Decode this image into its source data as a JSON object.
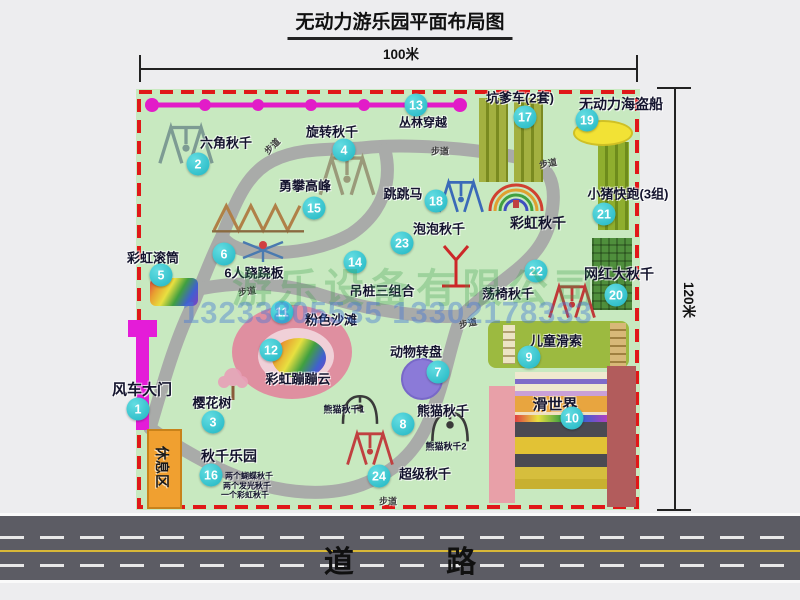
{
  "title": "无动力游乐园平面布局图",
  "dims": {
    "w": "100米",
    "h": "120米"
  },
  "road": {
    "label": "道 路"
  },
  "watermark": {
    "company": "游乐设备有限公司",
    "phone": "13233805535 13302178333"
  },
  "colors": {
    "map_bg": "#c8e9c0",
    "border_red": "#e01818",
    "path_gray": "#a8a8a8",
    "badge_cyan": "#2fc4cc",
    "magenta": "#e41cd8",
    "road_dark": "#5c5c64",
    "label_dark": "#14142e"
  },
  "attractions": [
    {
      "num": "1",
      "label": "风车大门",
      "bx": 138,
      "by": 409,
      "lx": 142,
      "ly": 389,
      "ls": 15
    },
    {
      "num": "2",
      "label": "六角秋千",
      "bx": 198,
      "by": 164,
      "lx": 226,
      "ly": 142
    },
    {
      "num": "3",
      "label": "樱花树",
      "bx": 213,
      "by": 422,
      "lx": 212,
      "ly": 402
    },
    {
      "num": "4",
      "label": "旋转秋千",
      "bx": 344,
      "by": 150,
      "lx": 332,
      "ly": 131
    },
    {
      "num": "5",
      "label": "彩虹滚筒",
      "bx": 161,
      "by": 275,
      "lx": 153,
      "ly": 257
    },
    {
      "num": "6",
      "label": "6人跷跷板",
      "bx": 224,
      "by": 254,
      "lx": 254,
      "ly": 272
    },
    {
      "num": "7",
      "label": "动物转盘",
      "bx": 438,
      "by": 372,
      "lx": 416,
      "ly": 351
    },
    {
      "num": "8",
      "label": "熊猫秋千",
      "bx": 403,
      "by": 424,
      "lx": 443,
      "ly": 410
    },
    {
      "num": "9",
      "label": "儿童滑索",
      "bx": 529,
      "by": 357,
      "lx": 556,
      "ly": 340
    },
    {
      "num": "10",
      "label": "滑世界",
      "bx": 572,
      "by": 418,
      "lx": 555,
      "ly": 404,
      "ls": 15
    },
    {
      "num": "11",
      "label": "粉色沙滩",
      "bx": 282,
      "by": 312,
      "lx": 331,
      "ly": 319
    },
    {
      "num": "12",
      "label": "彩虹蹦蹦云",
      "bx": 271,
      "by": 350,
      "lx": 298,
      "ly": 378
    },
    {
      "num": "13",
      "label": "丛林穿越",
      "bx": 416,
      "by": 105,
      "lx": 423,
      "ly": 122,
      "ls": 12
    },
    {
      "num": "14",
      "label": "吊桩三组合",
      "bx": 355,
      "by": 262,
      "lx": 382,
      "ly": 290
    },
    {
      "num": "15",
      "label": "勇攀高峰",
      "bx": 314,
      "by": 208,
      "lx": 305,
      "ly": 185
    },
    {
      "num": "16",
      "label": "秋千乐园",
      "bx": 211,
      "by": 475,
      "lx": 229,
      "ly": 456,
      "ls": 14
    },
    {
      "num": "17",
      "label": "坑爹车(2套)",
      "bx": 525,
      "by": 117,
      "lx": 520,
      "ly": 97
    },
    {
      "num": "18",
      "label": "跳跳马",
      "bx": 436,
      "by": 201,
      "lx": 403,
      "ly": 193
    },
    {
      "num": "19",
      "label": "无动力海盗船",
      "bx": 587,
      "by": 120,
      "lx": 621,
      "ly": 104,
      "ls": 14
    },
    {
      "num": "20",
      "label": "网红大秋千",
      "bx": 616,
      "by": 295,
      "lx": 619,
      "ly": 274,
      "ls": 14
    },
    {
      "num": "21",
      "label": "小猪快跑(3组)",
      "bx": 604,
      "by": 214,
      "lx": 628,
      "ly": 193
    },
    {
      "num": "22",
      "label": "荡椅秋千",
      "bx": 536,
      "by": 271,
      "lx": 508,
      "ly": 293
    },
    {
      "num": "23",
      "label": "泡泡秋千",
      "bx": 402,
      "by": 243,
      "lx": 439,
      "ly": 228
    },
    {
      "num": "24",
      "label": "超级秋千",
      "bx": 379,
      "by": 476,
      "lx": 425,
      "ly": 473
    }
  ],
  "texts": [
    {
      "t": "彩虹秋千",
      "x": 538,
      "y": 223,
      "s": 14
    },
    {
      "t": "休息区",
      "x": 162,
      "y": 467,
      "s": 14,
      "rot": 90,
      "c": "#1a1a1a"
    },
    {
      "t": "步道",
      "x": 272,
      "y": 146,
      "s": 9,
      "rot": -45,
      "c": "#3c3c3c"
    },
    {
      "t": "步道",
      "x": 440,
      "y": 151,
      "s": 9,
      "c": "#3c3c3c"
    },
    {
      "t": "步道",
      "x": 548,
      "y": 163,
      "s": 9,
      "rot": -10,
      "c": "#3c3c3c"
    },
    {
      "t": "步道",
      "x": 247,
      "y": 291,
      "s": 9,
      "rot": -8,
      "c": "#3c3c3c"
    },
    {
      "t": "步道",
      "x": 468,
      "y": 323,
      "s": 9,
      "rot": -12,
      "c": "#3c3c3c"
    },
    {
      "t": "步道",
      "x": 388,
      "y": 501,
      "s": 9,
      "c": "#3c3c3c"
    },
    {
      "t": "熊猫秋千1",
      "x": 344,
      "y": 409,
      "s": 9
    },
    {
      "t": "熊猫秋千2",
      "x": 446,
      "y": 446,
      "s": 9
    },
    {
      "t": "两个蝴蝶秋千",
      "x": 249,
      "y": 476,
      "s": 8
    },
    {
      "t": "两个发光秋千",
      "x": 247,
      "y": 486,
      "s": 8
    },
    {
      "t": "一个彩虹秋千",
      "x": 245,
      "y": 495,
      "s": 8
    }
  ],
  "shapes": [
    {
      "name": "windmill-gate-cap",
      "type": "rect",
      "x": 128,
      "y": 320,
      "w": 29,
      "h": 17,
      "color": "#e41cd8"
    },
    {
      "name": "windmill-gate-bar",
      "type": "rect",
      "x": 136,
      "y": 320,
      "w": 13,
      "h": 110,
      "color": "#e41cd8"
    },
    {
      "name": "rest-area-box",
      "type": "rect",
      "x": 147,
      "y": 429,
      "w": 31,
      "h": 76,
      "color": "#f0a030",
      "border": "#c8821a"
    },
    {
      "name": "kengdie-car-strip-1",
      "type": "stripes-v",
      "x": 479,
      "y": 98,
      "w": 29,
      "h": 84,
      "color": "#a3b040",
      "line": "#7a8a20"
    },
    {
      "name": "kengdie-car-strip-2",
      "type": "stripes-v",
      "x": 514,
      "y": 98,
      "w": 29,
      "h": 84,
      "color": "#a3b040",
      "line": "#7a8a20"
    },
    {
      "name": "pig-run-strip",
      "type": "stripes-v",
      "x": 598,
      "y": 142,
      "w": 31,
      "h": 88,
      "color": "#8fae2e",
      "line": "#6e8c1c"
    },
    {
      "name": "big-swing-patch",
      "type": "grid",
      "x": 592,
      "y": 238,
      "w": 40,
      "h": 72,
      "color": "#4f8f3c"
    },
    {
      "name": "zipline-strip",
      "type": "rect",
      "x": 488,
      "y": 321,
      "w": 141,
      "h": 47,
      "color": "#9cba40",
      "r": 8
    },
    {
      "name": "zipline-ladder-left",
      "type": "stripes-h",
      "x": 503,
      "y": 325,
      "w": 12,
      "h": 39,
      "color": "#ece4c4",
      "line": "#b0a070"
    },
    {
      "name": "zipline-ladder-right",
      "type": "stripes-h",
      "x": 610,
      "y": 323,
      "w": 16,
      "h": 44,
      "color": "#d8b878",
      "line": "#a08040"
    },
    {
      "name": "slide-world-left-bar",
      "type": "rect",
      "x": 489,
      "y": 386,
      "w": 26,
      "h": 117,
      "color": "#e8a0a8"
    },
    {
      "name": "slide-world-right-bar",
      "type": "rect",
      "x": 607,
      "y": 366,
      "w": 29,
      "h": 141,
      "color": "#b25c5c"
    },
    {
      "name": "pirate-ship-pool",
      "type": "ellipse",
      "x": 573,
      "y": 120,
      "w": 56,
      "h": 22,
      "color": "#f2e235",
      "border": "#cfc025"
    },
    {
      "name": "pink-beach-blob",
      "type": "ellipse",
      "x": 232,
      "y": 305,
      "w": 120,
      "h": 94,
      "color": "#df8fa0"
    },
    {
      "name": "pink-beach-inner",
      "type": "ellipse",
      "x": 258,
      "y": 328,
      "w": 76,
      "h": 56,
      "color": "#f0d0d8"
    },
    {
      "name": "rainbow-cloud-blob",
      "type": "rainbow-diag",
      "x": 272,
      "y": 338,
      "w": 54,
      "h": 40,
      "r": 50
    },
    {
      "name": "animal-turntable-circle",
      "type": "ellipse",
      "x": 401,
      "y": 358,
      "w": 38,
      "h": 38,
      "color": "#8b7ad8",
      "border": "#7868c8"
    },
    {
      "name": "rainbow-roller",
      "type": "rainbow-diag",
      "x": 150,
      "y": 278,
      "w": 48,
      "h": 28,
      "r": 6
    }
  ],
  "slide_stripes": [
    {
      "h": 7,
      "c": "#efe9cf"
    },
    {
      "h": 5,
      "c": "#7f6cc9"
    },
    {
      "h": 7,
      "c": "#efe9cf"
    },
    {
      "h": 5,
      "c": "#c9a0d8"
    },
    {
      "h": 16,
      "c": "#e8a53f"
    },
    {
      "h": 3,
      "c": "#f0e0c0"
    },
    {
      "h": 7,
      "c": "rainbow"
    },
    {
      "h": 15,
      "c": "#4a4a52"
    },
    {
      "h": 17,
      "c": "#e2c235"
    },
    {
      "h": 13,
      "c": "#4a4a52"
    },
    {
      "h": 12,
      "c": "#d6be3d"
    },
    {
      "h": 10,
      "c": "#c8b030"
    }
  ],
  "icons": [
    {
      "name": "hex-swing-icon",
      "type": "aframe",
      "x": 148,
      "y": 122,
      "w": 76,
      "h": 44,
      "color": "#7d9b93"
    },
    {
      "name": "rotate-swing-icon",
      "type": "aframe",
      "x": 316,
      "y": 152,
      "w": 62,
      "h": 46,
      "color": "#9a9a7a"
    },
    {
      "name": "climb-peak-icon",
      "type": "climb",
      "x": 212,
      "y": 196,
      "w": 92,
      "h": 40,
      "color": "#b08048"
    },
    {
      "name": "seesaw-icon",
      "type": "seesaw",
      "x": 240,
      "y": 236,
      "w": 46,
      "h": 28,
      "color": "#4a7ab0"
    },
    {
      "name": "jump-horse-icon",
      "type": "aframe",
      "x": 436,
      "y": 176,
      "w": 50,
      "h": 40,
      "color": "#3a6ab8"
    },
    {
      "name": "bubble-swing-icon",
      "type": "ypole",
      "x": 436,
      "y": 242,
      "w": 40,
      "h": 48,
      "color": "#cc2828"
    },
    {
      "name": "rainbow-swing-icon",
      "type": "arcs",
      "x": 487,
      "y": 176,
      "w": 58,
      "h": 38
    },
    {
      "name": "chair-swing-icon",
      "type": "aframe",
      "x": 546,
      "y": 280,
      "w": 52,
      "h": 42,
      "color": "#c03838"
    },
    {
      "name": "panda-swing-1-icon",
      "type": "arch",
      "x": 336,
      "y": 392,
      "w": 48,
      "h": 34,
      "color": "#3a3a3a"
    },
    {
      "name": "panda-swing-2-icon",
      "type": "arch",
      "x": 428,
      "y": 406,
      "w": 44,
      "h": 40,
      "color": "#3a3a3a"
    },
    {
      "name": "super-swing-icon",
      "type": "aframe",
      "x": 344,
      "y": 426,
      "w": 52,
      "h": 44,
      "color": "#c04040"
    },
    {
      "name": "cherry-tree-icon",
      "type": "tree",
      "x": 216,
      "y": 366,
      "w": 34,
      "h": 36
    }
  ]
}
